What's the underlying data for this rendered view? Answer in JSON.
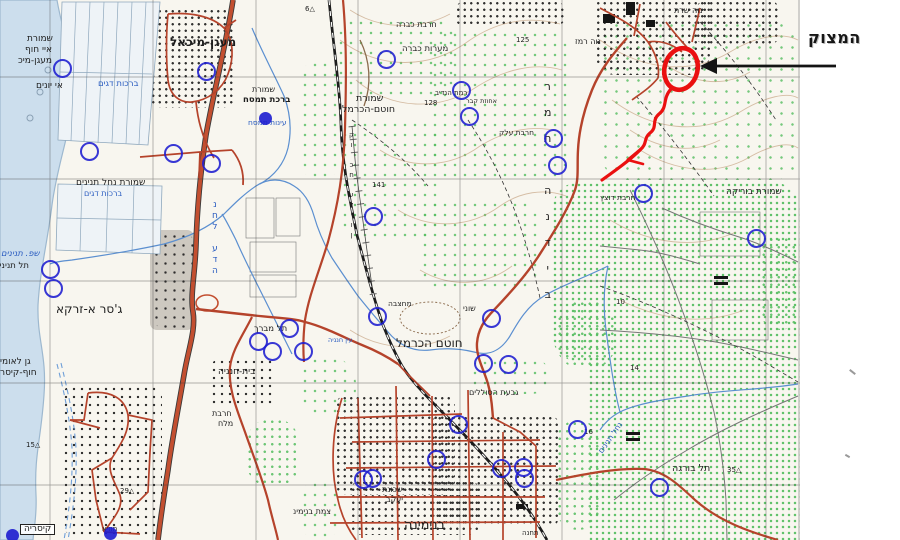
{
  "annotation": {
    "label": "המצוק",
    "circle_color": "#ea1010",
    "arrow_color": "#141414"
  },
  "colors": {
    "sea": "#ccdeed",
    "paper": "#f8f6ef",
    "road_red": "#b5432b",
    "highway_red": "#c34f30",
    "stream_blue": "#5b8fd0",
    "marker_blue": "#1d1dd0",
    "vegetation_green": "#55bd60",
    "contour_brown": "#b98f68"
  },
  "map_labels": [
    {
      "text": "מעגן-מיכאל",
      "x": 170,
      "y": 36,
      "size": 12,
      "bold": true
    },
    {
      "text": "שמורת",
      "x": 27,
      "y": 35,
      "size": 9
    },
    {
      "text": "איי חוף",
      "x": 25,
      "y": 46,
      "size": 9
    },
    {
      "text": "מעגן-מיכ",
      "x": 18,
      "y": 57,
      "size": 9
    },
    {
      "text": "אי יונים",
      "x": 36,
      "y": 82,
      "size": 9
    },
    {
      "text": "ברכות דגים",
      "x": 98,
      "y": 80,
      "size": 8.5,
      "color": "blue"
    },
    {
      "text": "שמורת",
      "x": 252,
      "y": 86,
      "size": 8
    },
    {
      "text": "ברכת תמסח",
      "x": 243,
      "y": 96,
      "size": 8.5,
      "bold": true
    },
    {
      "text": "עינות תמסח",
      "x": 248,
      "y": 119,
      "size": 7.5,
      "color": "blue"
    },
    {
      "text": "חרבת כברה",
      "x": 396,
      "y": 21,
      "size": 8
    },
    {
      "text": "מערות כברה",
      "x": 402,
      "y": 45,
      "size": 8.5
    },
    {
      "text": "נוה רמז",
      "x": 575,
      "y": 38,
      "size": 8
    },
    {
      "text": "נוה שרת",
      "x": 674,
      "y": 7,
      "size": 8
    },
    {
      "text": "שמורת",
      "x": 356,
      "y": 94,
      "size": 9.5
    },
    {
      "text": "חוטם-הכרמל",
      "x": 342,
      "y": 105,
      "size": 9.5
    },
    {
      "text": "רמת הנדיב",
      "x": 435,
      "y": 90,
      "size": 7
    },
    {
      "text": "אחוזת קבר",
      "x": 466,
      "y": 98,
      "size": 6.5
    },
    {
      "text": "חרבת עלק",
      "x": 499,
      "y": 129,
      "size": 7.5
    },
    {
      "text": "125",
      "x": 516,
      "y": 37,
      "size": 7
    },
    {
      "text": "141",
      "x": 372,
      "y": 182,
      "size": 7
    },
    {
      "text": "128",
      "x": 424,
      "y": 100,
      "size": 7
    },
    {
      "text": "שמורת נחל תנינים",
      "x": 76,
      "y": 179,
      "size": 9
    },
    {
      "text": "ברכות דגים",
      "x": 84,
      "y": 190,
      "size": 8,
      "color": "blue"
    },
    {
      "text": "שפ. תנינים",
      "x": 1,
      "y": 250,
      "size": 8.5,
      "color": "blue",
      "italic": true
    },
    {
      "text": "תל תנינים",
      "x": -6,
      "y": 262,
      "size": 8.5
    },
    {
      "text": "ג'סר א-זרקא",
      "x": 56,
      "y": 303,
      "size": 12
    },
    {
      "text": "תל מברך",
      "x": 254,
      "y": 325,
      "size": 8.5
    },
    {
      "text": "בית-חנניה",
      "x": 218,
      "y": 368,
      "size": 9
    },
    {
      "text": "חרבת",
      "x": 212,
      "y": 410,
      "size": 8
    },
    {
      "text": "מלח",
      "x": 218,
      "y": 420,
      "size": 8
    },
    {
      "text": "גן לאומי",
      "x": 0,
      "y": 358,
      "size": 9
    },
    {
      "text": "חוף-קיסר",
      "x": 0,
      "y": 369,
      "size": 9
    },
    {
      "text": "קיסריה",
      "x": 20,
      "y": 524,
      "size": 9,
      "boxed": true
    },
    {
      "text": "מוזיא",
      "x": 102,
      "y": 526,
      "size": 7
    },
    {
      "text": "מחצבה",
      "x": 388,
      "y": 300,
      "size": 7.5
    },
    {
      "text": "שוני",
      "x": 463,
      "y": 305,
      "size": 8
    },
    {
      "text": "חוטם הכרמל",
      "x": 396,
      "y": 337,
      "size": 12
    },
    {
      "text": "עין חנניה",
      "x": 328,
      "y": 337,
      "size": 6.5,
      "color": "blue"
    },
    {
      "text": "צמת בנימינ",
      "x": 293,
      "y": 508,
      "size": 8
    },
    {
      "text": "שכונת",
      "x": 382,
      "y": 486,
      "size": 8
    },
    {
      "text": "יעקב",
      "x": 386,
      "y": 496,
      "size": 8
    },
    {
      "text": "בנימינה",
      "x": 404,
      "y": 519,
      "size": 13
    },
    {
      "text": "גבעת הסוללים",
      "x": 469,
      "y": 389,
      "size": 8
    },
    {
      "text": "תחנה",
      "x": 522,
      "y": 530,
      "size": 7
    },
    {
      "text": "שמורת בוריקה",
      "x": 726,
      "y": 188,
      "size": 9
    },
    {
      "text": "חרבת דוצץ",
      "x": 600,
      "y": 194,
      "size": 7.5
    },
    {
      "text": "תל בורגה",
      "x": 672,
      "y": 464,
      "size": 9.5
    },
    {
      "text": "△35",
      "x": 727,
      "y": 467,
      "size": 7
    },
    {
      "text": "△29",
      "x": 120,
      "y": 488,
      "size": 7
    },
    {
      "text": "△15",
      "x": 26,
      "y": 442,
      "size": 7
    },
    {
      "text": "△6",
      "x": 305,
      "y": 6,
      "size": 7
    },
    {
      "text": "14",
      "x": 630,
      "y": 365,
      "size": 7
    },
    {
      "text": "16",
      "x": 584,
      "y": 429,
      "size": 7
    },
    {
      "text": "10",
      "x": 616,
      "y": 299,
      "size": 7
    }
  ],
  "vertical_labels": [
    {
      "text": "רמת הנדיב",
      "x": 544,
      "y": 74,
      "size": 11,
      "step": 26
    },
    {
      "text": "נחל עדה",
      "x": 212,
      "y": 200,
      "size": 9,
      "step": 11,
      "color": "blue"
    },
    {
      "text": "קו כח עליון",
      "x": 349,
      "y": 130,
      "size": 7,
      "step": 10
    }
  ],
  "rotated_labels": [
    {
      "text": "נחל תנינים",
      "x": 600,
      "y": 448,
      "size": 8,
      "deg": -55,
      "color": "blue"
    }
  ],
  "marker_circles": [
    [
      61,
      67
    ],
    [
      205,
      70
    ],
    [
      88,
      150
    ],
    [
      172,
      152
    ],
    [
      210,
      162
    ],
    [
      385,
      58
    ],
    [
      460,
      89
    ],
    [
      468,
      115
    ],
    [
      552,
      137
    ],
    [
      556,
      164
    ],
    [
      642,
      192
    ],
    [
      755,
      237
    ],
    [
      372,
      215
    ],
    [
      49,
      268
    ],
    [
      52,
      287
    ],
    [
      288,
      327
    ],
    [
      257,
      340
    ],
    [
      271,
      350
    ],
    [
      376,
      315
    ],
    [
      302,
      350
    ],
    [
      490,
      317
    ],
    [
      482,
      362
    ],
    [
      507,
      363
    ],
    [
      457,
      423
    ],
    [
      435,
      458
    ],
    [
      500,
      467
    ],
    [
      522,
      466
    ],
    [
      523,
      477
    ],
    [
      362,
      478
    ],
    [
      371,
      477
    ],
    [
      576,
      428
    ],
    [
      658,
      486
    ]
  ],
  "filled_markers": [
    [
      265,
      118
    ],
    [
      110,
      533
    ],
    [
      12,
      535
    ]
  ]
}
